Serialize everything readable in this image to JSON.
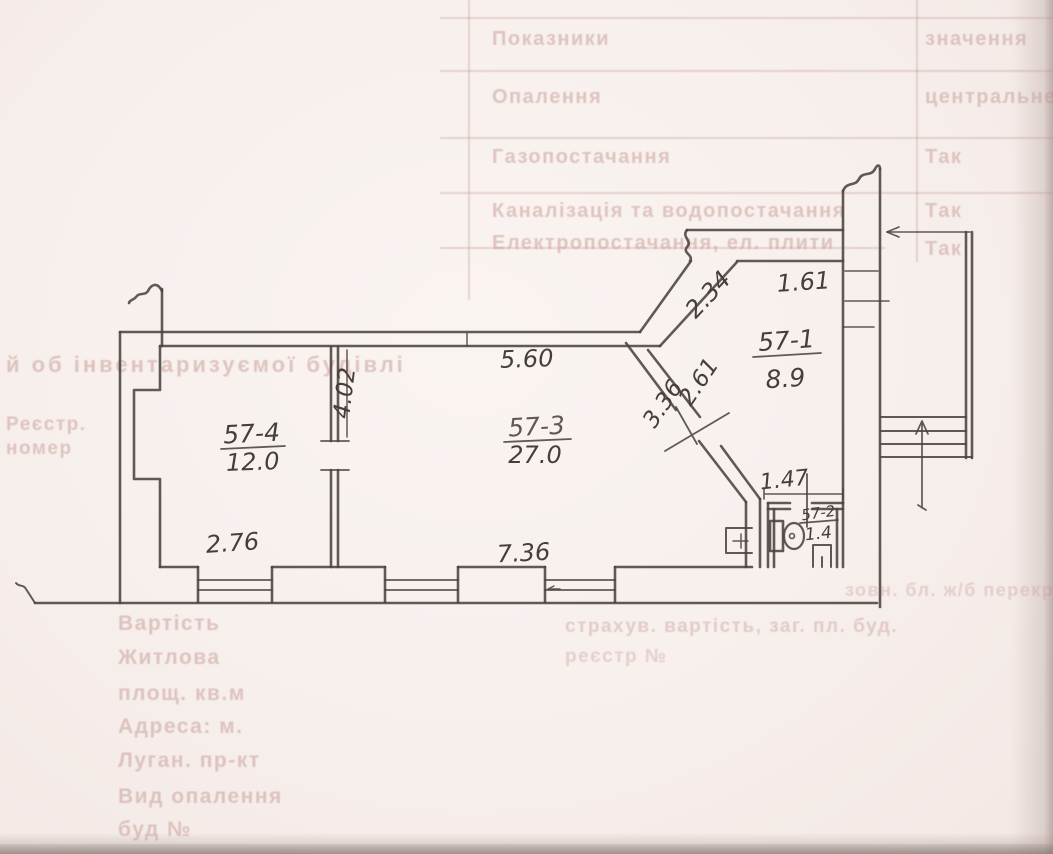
{
  "page": {
    "kind": "scanned technical passport page with hand-drawn apartment floor plan"
  },
  "plan": {
    "rooms": [
      {
        "number": "57-4",
        "area": "12.0"
      },
      {
        "number": "57-3",
        "area": "27.0"
      },
      {
        "number": "57-1",
        "area": "8.9"
      },
      {
        "number": "57-2",
        "area": "1.4"
      }
    ],
    "dims": {
      "top_room3": "5.60",
      "partition": "4.02",
      "diag_upper": "2.34",
      "room1_top": "1.61",
      "diag_inner": "2.61",
      "diag_outer": "3.36",
      "wc_top": "1.47",
      "bottom_room4": "2.76",
      "bottom_room3": "7.36"
    }
  },
  "ghost_table": {
    "note": "bleed-through text from reverse side, barely legible",
    "rows": [
      {
        "label": "Показники",
        "value": "значення"
      },
      {
        "label": "Опалення",
        "value": "центральне"
      },
      {
        "label": "Газопостачання",
        "value": "Так"
      },
      {
        "label": "Каналізація та водопостачання",
        "value": "Так"
      },
      {
        "label": "Електропостачання, ел. плити",
        "value": "Так"
      }
    ]
  },
  "ghost_left": {
    "heading": "й об інвентаризуємої будівлі",
    "reg1": "Реєстр.",
    "reg2": "номер",
    "lines": [
      "Вартість",
      "Житлова",
      "площ. кв.м",
      "Адреса: м.",
      "Луган. пр-кт",
      "Вид опалення",
      "буд №"
    ]
  },
  "ghost_bottom": {
    "lines": [
      "зовн. бл. ж/б перекр.",
      "страхув. вартість, заг. пл. буд.",
      "реєстр №"
    ]
  }
}
